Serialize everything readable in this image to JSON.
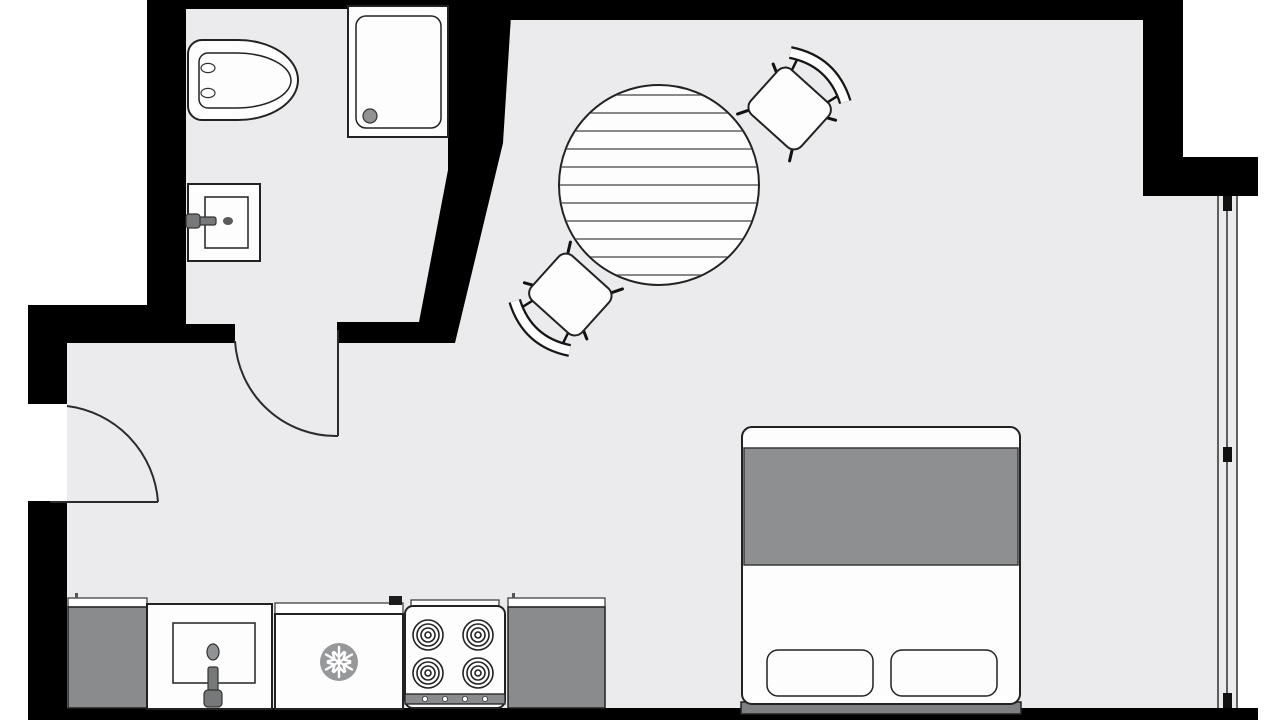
{
  "app": {
    "title": "Studio apartment floor plan"
  },
  "colors": {
    "exterior": "#ffffff",
    "floor": "#ebebed",
    "wall": "#000000",
    "fixture_white": "#fdfdfd",
    "fixture_gray": "#8e8f91",
    "counter_gray": "#8a8b8d",
    "headboard_gray": "#7e8082",
    "blanket_gray": "#8e8f91",
    "snowflake_bg": "#96989a",
    "drain_gray": "#909294",
    "faucet_gray": "#77787a",
    "tick_gray": "#555555"
  },
  "rooms": [
    {
      "name": "bathroom",
      "fixtures": [
        "toilet",
        "shower-tray",
        "wall-sink"
      ]
    },
    {
      "name": "living-sleeping-area",
      "fixtures": [
        "round-dining-table",
        "dining-chair",
        "dining-chair",
        "double-bed"
      ]
    },
    {
      "name": "kitchenette",
      "fixtures": [
        "counter-left",
        "kitchen-sink",
        "refrigerator",
        "stove",
        "counter-right"
      ]
    }
  ],
  "architecture": {
    "doors": [
      {
        "name": "entry-door",
        "swing": "quarter-arc"
      },
      {
        "name": "bathroom-door",
        "swing": "quarter-arc"
      }
    ],
    "windows": [
      {
        "name": "right-wall-window",
        "style": "triple-line glazing with mullion ticks"
      }
    ],
    "stove_burners": 4,
    "bed_pillows": 2,
    "table_fill": "horizontal hatch lines"
  }
}
